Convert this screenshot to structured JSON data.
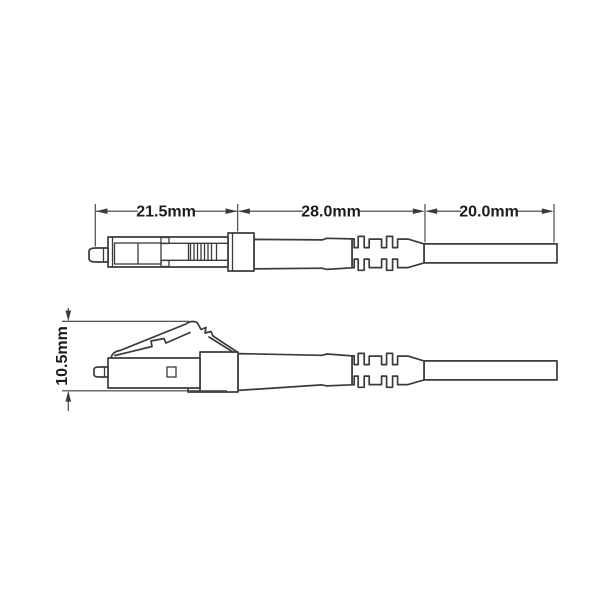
{
  "diagram": {
    "dimensions": {
      "front_length": "21.5mm",
      "body_length": "28.0mm",
      "cable_length": "20.0mm",
      "height": "10.5mm"
    },
    "colors": {
      "line": "#3b3b3b",
      "text": "#1c1c1c",
      "background": "#ffffff"
    }
  }
}
